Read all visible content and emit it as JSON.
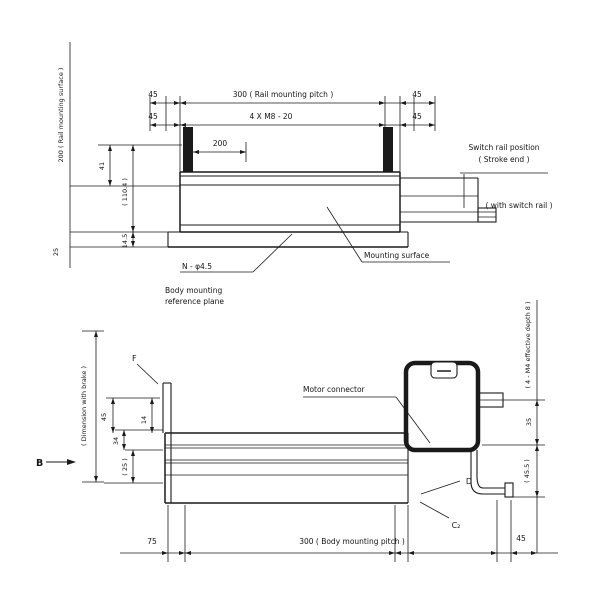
{
  "colors": {
    "line": "#1a1a1a",
    "background": "#ffffff"
  },
  "top_view": {
    "left_vertical_label": "200 ( Rail mounting surface )",
    "dim_row1_left_45": "45",
    "dim_row1_main": "300 ( Rail mounting pitch )",
    "dim_row1_right_45": "45",
    "dim_row2_left_45": "45",
    "dim_row2_main": "4 X M8 - 20",
    "dim_row2_right_45": "45",
    "dim_200": "200",
    "dim_41": "41",
    "dim_110_4": "( 110.4 )",
    "dim_14_5": "14.5",
    "dim_25": "25",
    "switch_label_line1": "Switch rail position",
    "switch_label_line2": "( Stroke end )",
    "switch_section_label": "( with switch rail )",
    "mounting_surface_label": "Mounting surface",
    "hole_label": "N - φ4.5",
    "body_ref_line1": "Body mounting",
    "body_ref_line2": "reference plane"
  },
  "bottom_view": {
    "view_arrow_label": "B",
    "brake_label": "( Dimension with brake )",
    "f_label": "F",
    "dim_45_left": "45",
    "dim_34": "34",
    "dim_25_paren": "( 25 )",
    "dim_14": "14",
    "connector_label": "Motor connector",
    "depth_label": "( 4 - M4 effective depth 8 )",
    "dim_35_right": "35",
    "dim_45_5": "( 45.5 )",
    "d_label": "D",
    "c2_label": "C₂",
    "dim_75": "75",
    "dim_main": "300 ( Body mounting pitch )",
    "dim_45_bottom": "45"
  }
}
